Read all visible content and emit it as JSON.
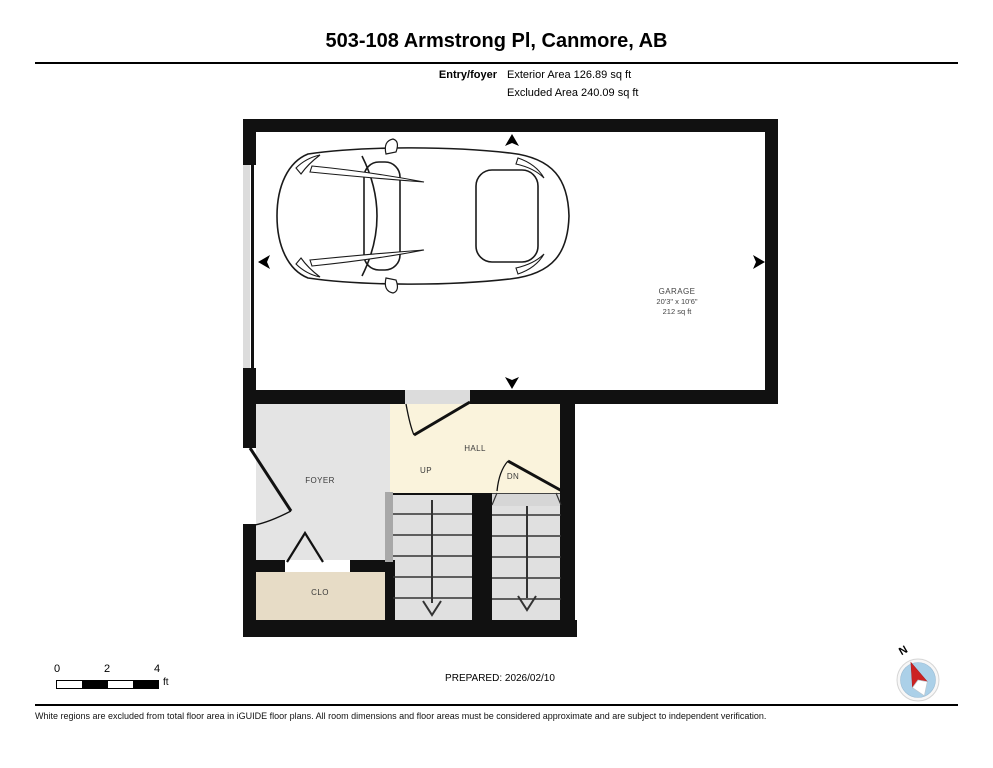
{
  "header": {
    "title": "503-108 Armstrong Pl, Canmore, AB",
    "floor_label": "Entry/foyer",
    "exterior_area": "Exterior Area 126.89 sq ft",
    "excluded_area": "Excluded Area 240.09 sq ft"
  },
  "rooms": {
    "garage": {
      "name": "GARAGE",
      "dimensions": "20'3\" x 10'6\"",
      "area": "212 sq ft"
    },
    "foyer": {
      "name": "FOYER"
    },
    "hall": {
      "name": "HALL"
    },
    "closet": {
      "name": "CLO"
    },
    "stairs_up": {
      "label": "UP"
    },
    "stairs_down": {
      "label": "DN"
    }
  },
  "footer": {
    "scale": {
      "ticks": [
        "0",
        "2",
        "4"
      ],
      "unit": "ft"
    },
    "prepared": "PREPARED: 2026/02/10",
    "compass": {
      "label": "N"
    },
    "disclaimer": "White regions are excluded from total floor area in iGUIDE floor plans. All room dimensions and floor areas must be considered approximate and are subject to independent verification."
  },
  "colors": {
    "wall": "#111111",
    "foyer_fill": "#e4e4e4",
    "hall_fill": "#faf3dc",
    "closet_fill": "#e7dcc6",
    "stairs_fill": "#e0e0e0",
    "threshold": "#dcdcdc",
    "half_wall": "#a8a8a8",
    "compass_blue": "#abd0e8",
    "compass_red": "#cc2222"
  }
}
